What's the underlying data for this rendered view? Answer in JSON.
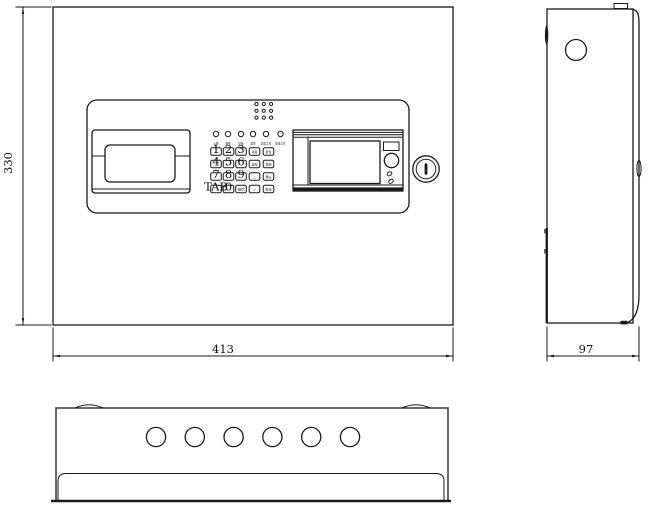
{
  "drawing_title": "fire-alarm-control-panel-outline-drawing",
  "colors": {
    "line": "#1a1a1a",
    "background": "#ffffff"
  },
  "dimensions": {
    "front_width": "413",
    "front_height": "330",
    "side_depth": "97"
  },
  "front_view": {
    "indicator_leds": [
      "火警",
      "故障",
      "屏蔽",
      "监管",
      "主电工作",
      "备电工作"
    ],
    "keypad_rows": [
      [
        "1",
        "2",
        "3",
        "消音",
        "复位"
      ],
      [
        "4",
        "5",
        "6",
        "自检",
        "查询"
      ],
      [
        "7",
        "8",
        "9",
        "△",
        "确认"
      ],
      [
        "TAB",
        "0",
        "翻页",
        "▽",
        "取消"
      ]
    ],
    "speaker_grid": {
      "rows": 3,
      "cols": 3
    },
    "lock_symbol": "I"
  },
  "bottom_view": {
    "cable_hole_count": 6
  }
}
